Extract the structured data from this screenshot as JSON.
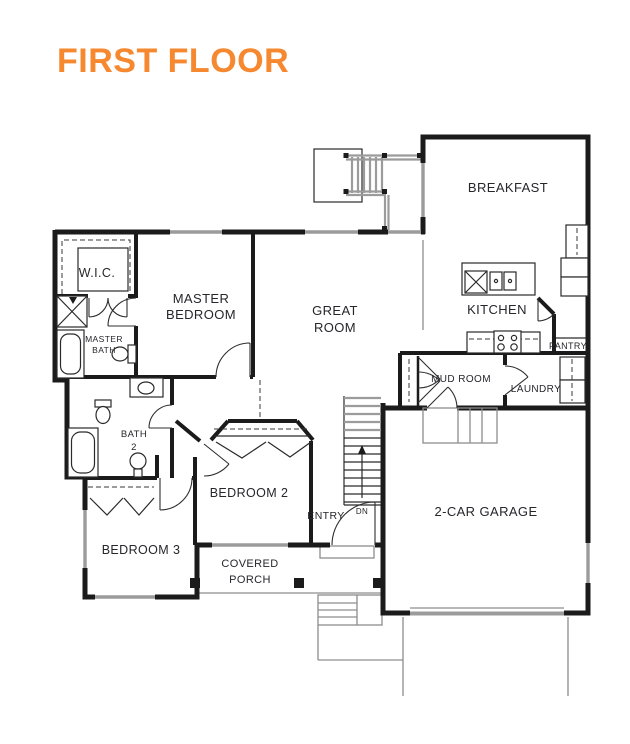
{
  "title": "FIRST FLOOR",
  "colors": {
    "accent": "#F6882F",
    "wall": "#1B1B1B",
    "gray": "#9B9B9B",
    "label": "#26262B"
  },
  "rooms": {
    "wic": "W.I.C.",
    "master_bedroom": {
      "line1": "MASTER",
      "line2": "BEDROOM"
    },
    "master_bath": {
      "line1": "MASTER",
      "line2": "BATH"
    },
    "great_room": {
      "line1": "GREAT",
      "line2": "ROOM"
    },
    "breakfast": "BREAKFAST",
    "kitchen": "KITCHEN",
    "pantry": "PANTRY",
    "mud_room": "MUD ROOM",
    "laundry": "LAUNDRY",
    "garage": "2-CAR GARAGE",
    "bedroom2": "BEDROOM 2",
    "bedroom3": "BEDROOM 3",
    "bath2": {
      "line1": "BATH",
      "line2": "2"
    },
    "entry": "ENTRY",
    "covered_porch": {
      "line1": "COVERED",
      "line2": "PORCH"
    },
    "stairs_dn": "DN"
  }
}
